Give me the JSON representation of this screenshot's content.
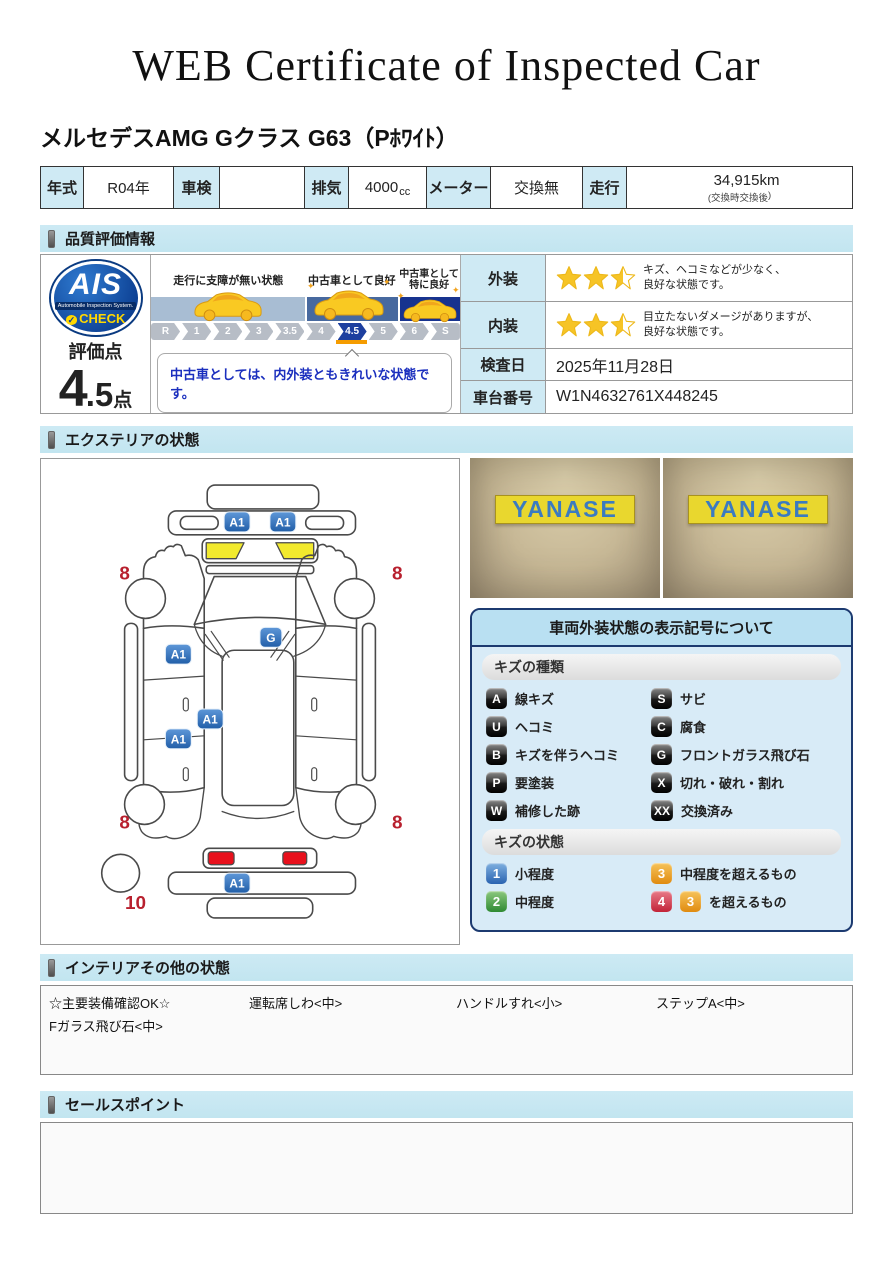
{
  "page": {
    "title": "WEB Certificate of Inspected Car",
    "vehicle_name": "メルセデスAMG Gクラス G63（Pﾎﾜｲﾄ）"
  },
  "info_table": {
    "year_label": "年式",
    "year_value": "R04年",
    "shaken_label": "車検",
    "shaken_value": "",
    "displacement_label": "排気",
    "displacement_value": "4000",
    "displacement_unit": "cc",
    "meter_label": "メーター",
    "meter_value": "交換無",
    "mileage_label": "走行",
    "mileage_value": "34,915km",
    "mileage_note_open": "(交換時",
    "mileage_note_mid": "交換後",
    "mileage_note_close": ")"
  },
  "section_headers": {
    "quality": "品質評価情報",
    "exterior": "エクステリアの状態",
    "interior": "インテリアその他の状態",
    "sales": "セールスポイント"
  },
  "quality": {
    "ais": {
      "name": "AIS",
      "subtitle": "Automobile Inspection System.",
      "check": "CHECK"
    },
    "score": {
      "label": "評価点",
      "integer": "4",
      "decimal": ".5",
      "unit": "点"
    },
    "scale": {
      "zones": [
        {
          "label": "走行に支障が無い状態"
        },
        {
          "label": "中古車として良好"
        },
        {
          "label": "中古車として\n特に良好"
        }
      ],
      "ticks": [
        "R",
        "1",
        "2",
        "3",
        "3.5",
        "4",
        "4.5",
        "5",
        "6",
        "S"
      ],
      "active_tick": "4.5"
    },
    "comment": "中古車としては、内外装ともきれいな状態です。",
    "ratings": [
      {
        "label": "外装",
        "stars": 2.5,
        "lines": [
          "キズ、ヘコミなどが少なく、",
          "良好な状態です。"
        ]
      },
      {
        "label": "内装",
        "stars": 2.5,
        "lines": [
          "目立たないダメージがありますが、",
          "良好な状態です。"
        ]
      }
    ],
    "inspection": {
      "label": "検査日",
      "value": "2025年11月28日"
    },
    "chassis": {
      "label": "車台番号",
      "value": "W1N4632761X448245"
    }
  },
  "exterior": {
    "photos": [
      {
        "sign_text": "YANASE"
      },
      {
        "sign_text": "YANASE"
      }
    ],
    "diagram": {
      "markers": [
        {
          "label": "A1",
          "x": 197,
          "y": 63
        },
        {
          "label": "A1",
          "x": 243,
          "y": 63
        },
        {
          "label": "G",
          "x": 231,
          "y": 179
        },
        {
          "label": "A1",
          "x": 138,
          "y": 196
        },
        {
          "label": "A1",
          "x": 170,
          "y": 261
        },
        {
          "label": "A1",
          "x": 138,
          "y": 281
        },
        {
          "label": "A1",
          "x": 197,
          "y": 426
        }
      ],
      "numbers": [
        {
          "text": "8",
          "x": 84,
          "y": 121
        },
        {
          "text": "8",
          "x": 358,
          "y": 121
        },
        {
          "text": "8",
          "x": 84,
          "y": 371
        },
        {
          "text": "8",
          "x": 358,
          "y": 371
        },
        {
          "text": "10",
          "x": 95,
          "y": 452
        }
      ]
    },
    "legend": {
      "title": "車両外装状態の表示記号について",
      "kind_header": "キズの種類",
      "kinds": [
        {
          "symbol": "A",
          "label": "線キズ"
        },
        {
          "symbol": "S",
          "label": "サビ"
        },
        {
          "symbol": "U",
          "label": "ヘコミ"
        },
        {
          "symbol": "C",
          "label": "腐食"
        },
        {
          "symbol": "B",
          "label": "キズを伴うヘコミ"
        },
        {
          "symbol": "G",
          "label": "フロントガラス飛び石"
        },
        {
          "symbol": "P",
          "label": "要塗装"
        },
        {
          "symbol": "X",
          "label": "切れ・破れ・割れ"
        },
        {
          "symbol": "W",
          "label": "補修した跡"
        },
        {
          "symbol": "XX",
          "label": "交換済み"
        }
      ],
      "state_header": "キズの状態",
      "states": [
        {
          "symbol": "1",
          "color": "blue",
          "label": "小程度"
        },
        {
          "symbol": "3",
          "color": "orange",
          "label": "中程度を超えるもの"
        },
        {
          "symbol": "2",
          "color": "green",
          "label": "中程度"
        },
        {
          "symbol": "4",
          "color": "red",
          "extra": "3",
          "extra_color": "orange",
          "label": "を超えるもの"
        }
      ]
    }
  },
  "interior": {
    "row1": [
      "☆主要装備確認OK☆",
      "運転席しわ<中>",
      "ハンドルすれ<小>",
      "ステップA<中>"
    ],
    "row2": [
      "Fガラス飛び石<中>"
    ]
  },
  "sales": {
    "content": ""
  },
  "colors": {
    "marker_blue": "#2a63b0",
    "star_yellow": "#f6c426",
    "number_red": "#b8202e",
    "band_light": "#a8bdd3",
    "band_mid": "#47699f",
    "band_dark": "#17338f",
    "active_tick_blue": "#1d3f9f",
    "section_header_bg": "#c9e9f3"
  }
}
